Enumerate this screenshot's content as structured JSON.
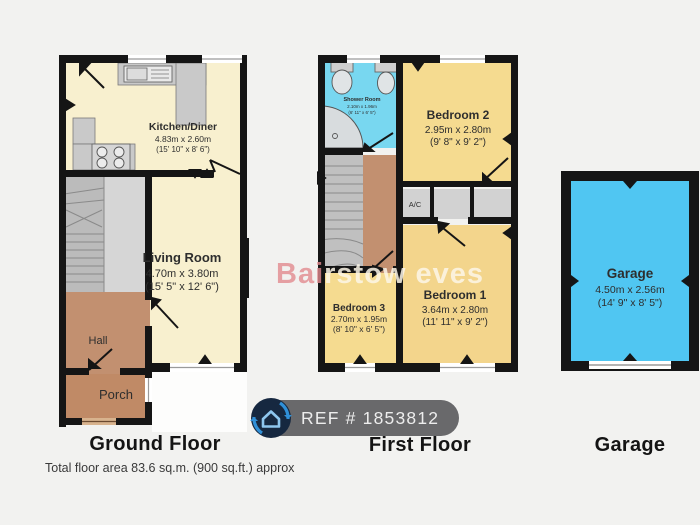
{
  "badge": {
    "ref": "REF # 1853812"
  },
  "watermark": {
    "part1": "Bai",
    "part2": "rstow",
    "part3": " eves"
  },
  "footer": {
    "total_area": "Total floor area 83.6 sq.m. (900 sq.ft.) approx"
  },
  "floors": {
    "ground": {
      "label": "Ground Floor",
      "rooms": {
        "kitchen": {
          "name": "Kitchen/Diner",
          "dims_m": "4.83m x 2.60m",
          "dims_ft": "(15' 10\" x 8' 6\")"
        },
        "living": {
          "name": "Living Room",
          "dims_m": "4.70m x 3.80m",
          "dims_ft": "(15' 5\" x 12' 6\")"
        },
        "hall": {
          "name": "Hall"
        },
        "porch": {
          "name": "Porch"
        }
      }
    },
    "first": {
      "label": "First Floor",
      "rooms": {
        "shower": {
          "name": "Shower Room",
          "dims_m": "2.10m x 1.96m",
          "dims_ft": "(6' 11\" x 6' 5\")"
        },
        "bedroom2": {
          "name": "Bedroom 2",
          "dims_m": "2.95m x 2.80m",
          "dims_ft": "(9' 8\" x 9' 2\")"
        },
        "bedroom1": {
          "name": "Bedroom 1",
          "dims_m": "3.64m x 2.80m",
          "dims_ft": "(11' 11\" x 9' 2\")"
        },
        "bedroom3": {
          "name": "Bedroom 3",
          "dims_m": "2.70m x 1.95m",
          "dims_ft": "(8' 10\" x 6' 5\")"
        },
        "ac": {
          "name": "A/C"
        }
      }
    },
    "garage": {
      "label": "Garage",
      "rooms": {
        "garage": {
          "name": "Garage",
          "dims_m": "4.50m x 2.56m",
          "dims_ft": "(14' 9\" x 8' 5\")"
        }
      }
    }
  },
  "colors": {
    "background": "#f2f2f0",
    "wall": "#151515",
    "room_cream": "#f8f0cf",
    "room_yellow": "#f5db90",
    "room_yellow_deep": "#f3d58c",
    "room_tan": "#c29070",
    "shower_cyan": "#78d7f0",
    "garage_cyan": "#50c6f2",
    "closet_gray": "#d2d2d2",
    "stairs_gray": "#c0c0c0",
    "badge_bg": "#636365",
    "badge_icon_bg": "#162840",
    "badge_icon_blue": "#3090d8",
    "watermark_red": "#e1898f",
    "watermark_cream": "#fbf6e8"
  }
}
